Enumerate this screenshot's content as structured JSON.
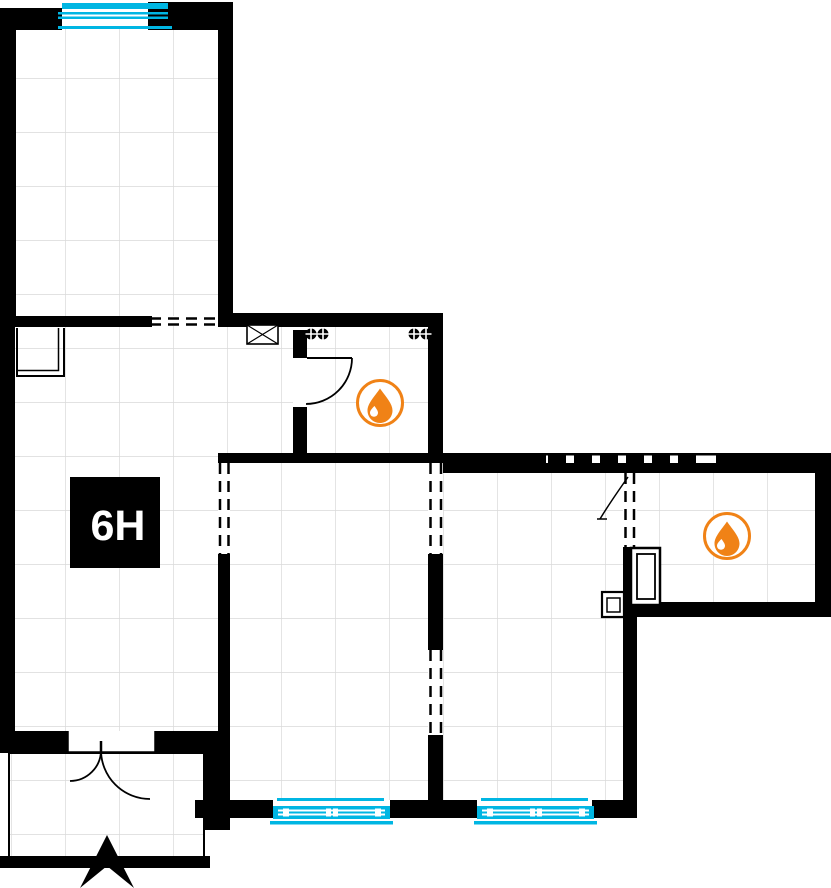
{
  "plan": {
    "unit_label": "6H",
    "colors": {
      "wall": "#000000",
      "window": "#00b6e3",
      "accent": "#f08216",
      "grid": "#d9d9d9",
      "bg": "#ffffff",
      "label_text": "#ffffff"
    },
    "icons": [
      {
        "name": "water-drop-icon",
        "location": "wet-room-1"
      },
      {
        "name": "water-drop-icon",
        "location": "wet-room-2"
      },
      {
        "name": "north-arrow-icon",
        "location": "entrance"
      }
    ]
  }
}
